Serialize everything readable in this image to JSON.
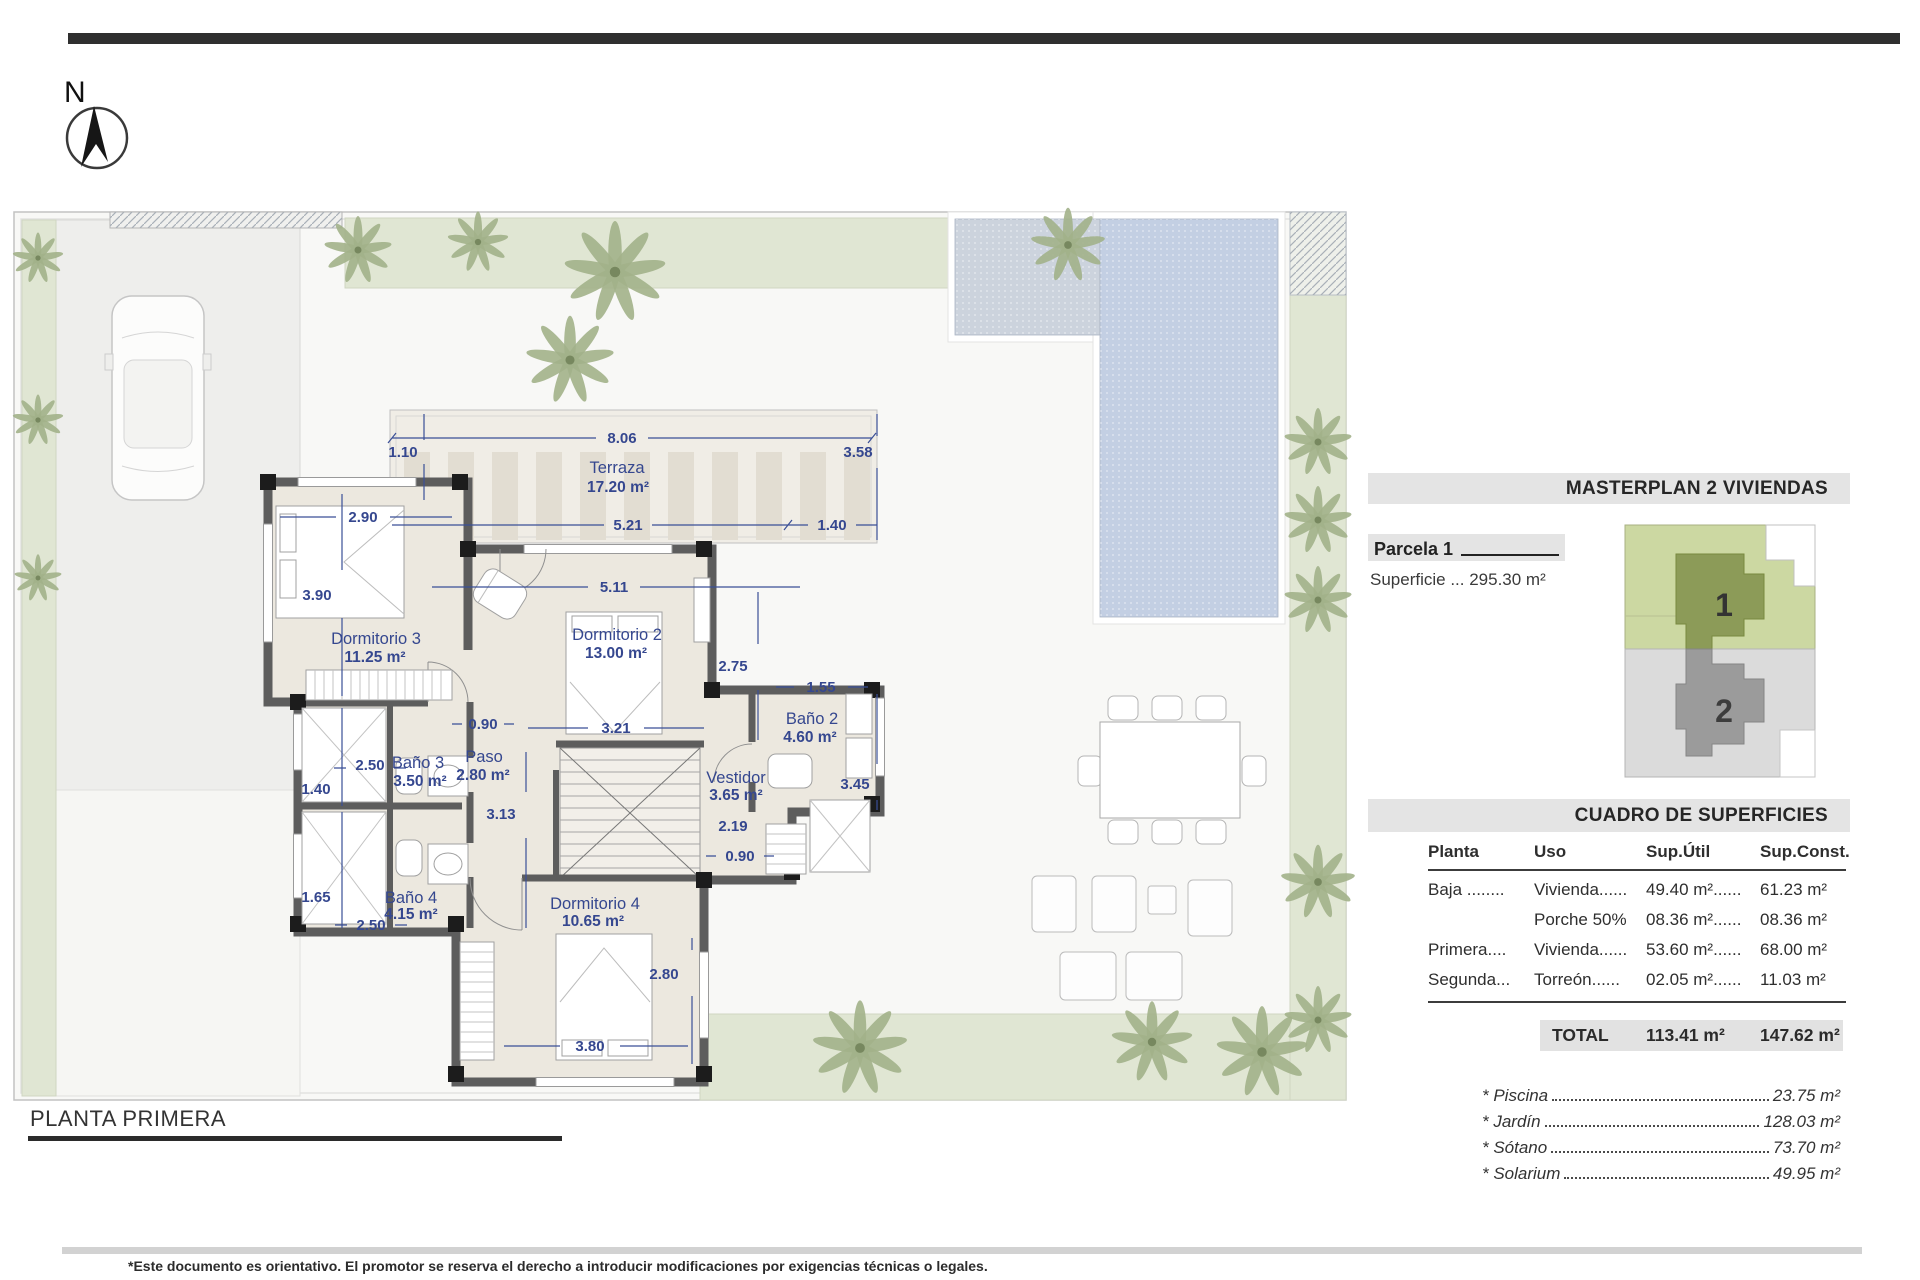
{
  "page": {
    "title": "PLANTA PRIMERA",
    "north": "N",
    "disclaimer": "*Este documento es orientativo. El promotor se reserva el derecho a introducir modificaciones por exigencias técnicas o legales."
  },
  "plan": {
    "rooms": [
      {
        "name": "Terraza",
        "area": "17.20 m²"
      },
      {
        "name": "Dormitorio 3",
        "area": "11.25 m²"
      },
      {
        "name": "Dormitorio 2",
        "area": "13.00 m²"
      },
      {
        "name": "Baño 2",
        "area": "4.60 m²"
      },
      {
        "name": "Paso",
        "area": "2.80 m²"
      },
      {
        "name": "Baño 3",
        "area": "3.50 m²"
      },
      {
        "name": "Vestidor",
        "area": "3.65 m²"
      },
      {
        "name": "Baño 4",
        "area": "4.15 m²"
      },
      {
        "name": "Dormitorio 4",
        "area": "10.65 m²"
      }
    ],
    "dims": [
      "8.06",
      "1.10",
      "3.58",
      "2.90",
      "5.21",
      "1.40",
      "5.11",
      "3.90",
      "2.75",
      "1.55",
      "3.21",
      "0.90",
      "2.50",
      "1.40",
      "3.45",
      "3.13",
      "2.19",
      "0.90",
      "1.65",
      "2.50",
      "2.80",
      "3.80"
    ]
  },
  "panel": {
    "masterplan_title": "MASTERPLAN 2 VIVIENDAS",
    "parcela_label": "Parcela 1",
    "superficie": "Superficie ... 295.30 m²",
    "plots": [
      "1",
      "2"
    ],
    "cuadro_title": "CUADRO DE SUPERFICIES",
    "table": {
      "headers": [
        "Planta",
        "Uso",
        "Sup.Útil",
        "Sup.Const."
      ],
      "rows": [
        [
          "Baja ........",
          "Vivienda......",
          "49.40 m²......",
          "61.23 m²"
        ],
        [
          "",
          "Porche 50%",
          "08.36 m²......",
          "08.36 m²"
        ],
        [
          "Primera....",
          "Vivienda......",
          "53.60 m²......",
          "68.00 m²"
        ],
        [
          "Segunda...",
          "Torreón......",
          "02.05 m²......",
          "11.03 m²"
        ]
      ],
      "total_label": "TOTAL",
      "total_util": "113.41 m²",
      "total_const": "147.62 m²"
    },
    "extras": [
      {
        "label": "* Piscina",
        "value": "23.75 m²"
      },
      {
        "label": "* Jardín",
        "value": "128.03 m²"
      },
      {
        "label": "* Sótano",
        "value": "73.70 m²"
      },
      {
        "label": "* Solarium",
        "value": "49.95 m²"
      }
    ]
  },
  "colors": {
    "accent_navy": "#35478f",
    "wall_gray": "#5d5d5d",
    "pool_blue": "#c3cfe3",
    "garden_green": "#e0e6d3",
    "plot1_green": "#8c9b58",
    "plot2_gray": "#9b9b9b"
  }
}
